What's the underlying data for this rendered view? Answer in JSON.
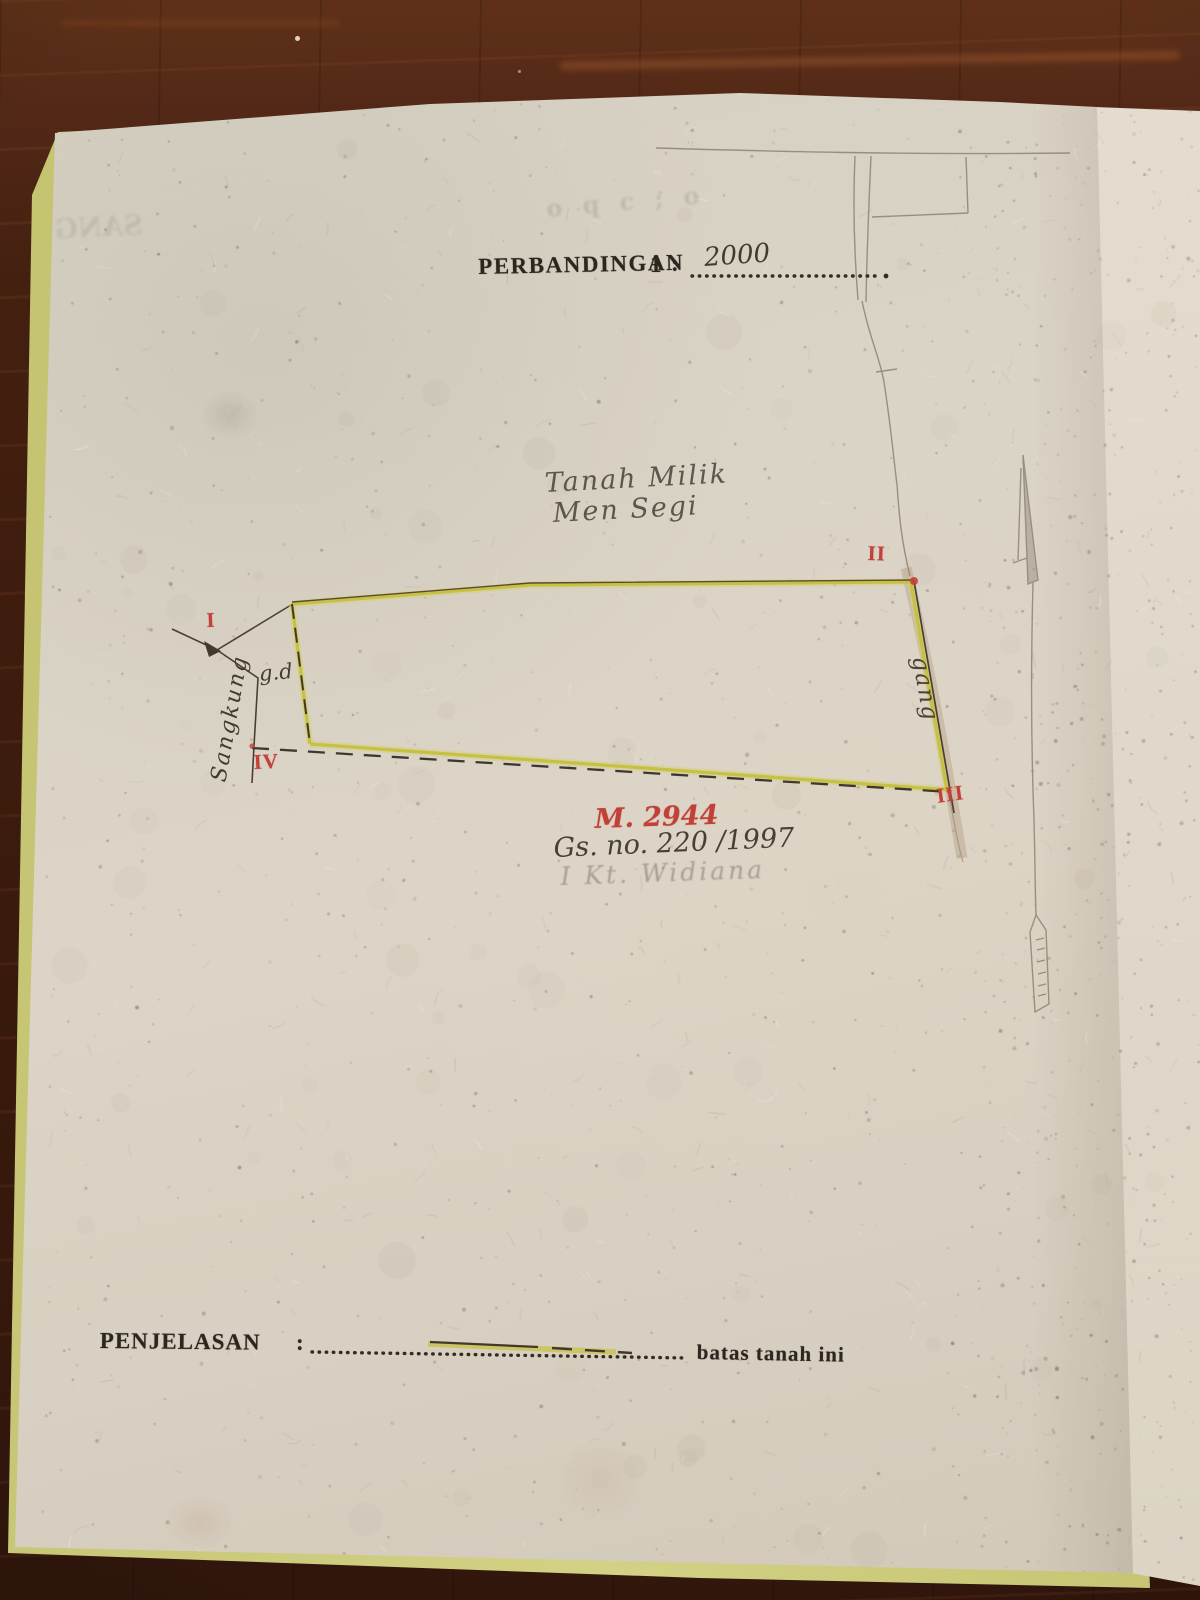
{
  "photo": {
    "ghost_top_left": "SANG",
    "ghost_top_right": "o q c ; o"
  },
  "header": {
    "scale_label": "PERBANDINGAN",
    "scale_number": "1",
    "scale_colon": ":",
    "scale_value": "2000"
  },
  "map": {
    "owner_line1": "Tanah Milik",
    "owner_line2": "Men Segi",
    "annotation_gd": "g.d",
    "road_left": "Sangkung",
    "road_right": "gang",
    "parcel_no_red": "M. 2944",
    "surat_ukur_ref": "Gs. no. 220 /1997",
    "name_faint": "I Kt. Widiana",
    "corners": [
      "I",
      "II",
      "III",
      "IV"
    ]
  },
  "footer": {
    "label": "PENJELASAN",
    "colon": ":",
    "legend_text": "batas tanah ini"
  },
  "colors": {
    "boundary_yellow": "#c5c13e",
    "ink_dark": "#43382b",
    "marker_red": "#c13a35",
    "paper": "#d9d3c7",
    "wood": "#3a1709",
    "cover_edge": "#c9c973"
  }
}
